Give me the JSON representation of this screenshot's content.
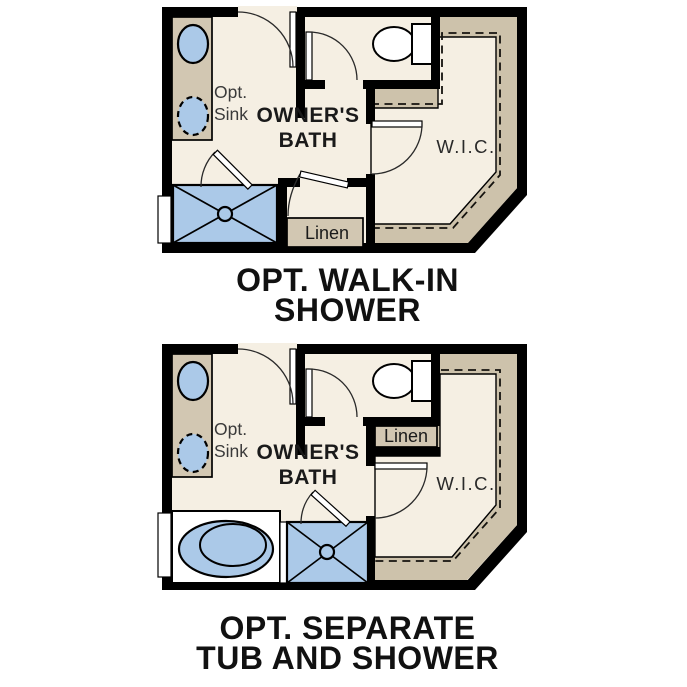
{
  "colors": {
    "wall": "#000000",
    "floor": "#f5efe3",
    "millwork": "#d2c7b2",
    "shelf": "#cdc2ab",
    "fixture": "#abc9e8"
  },
  "plans": [
    {
      "name": "Optional walk-in shower floor plan",
      "title_line1": "OPT. WALK-IN",
      "title_line2": "SHOWER",
      "labels": {
        "opt_sink_line1": "Opt.",
        "opt_sink_line2": "Sink",
        "room_line1": "OWNER'S",
        "room_line2": "BATH",
        "closet": "W.I.C.",
        "linen": "Linen"
      }
    },
    {
      "name": "Optional separate tub and shower floor plan",
      "title_line1": "OPT. SEPARATE",
      "title_line2": "TUB AND SHOWER",
      "labels": {
        "opt_sink_line1": "Opt.",
        "opt_sink_line2": "Sink",
        "room_line1": "OWNER'S",
        "room_line2": "BATH",
        "closet": "W.I.C.",
        "linen": "Linen"
      }
    }
  ]
}
